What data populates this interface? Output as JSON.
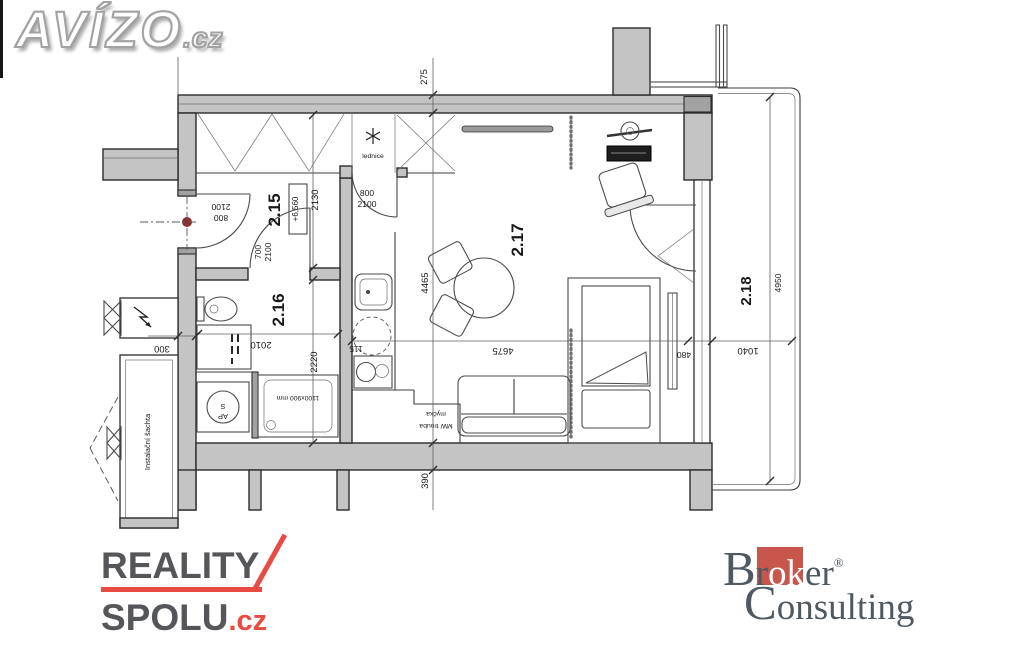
{
  "logos": {
    "avizo": {
      "name": "AVÍZO",
      "tld": ".cz"
    },
    "reality": {
      "line1": "REALITY",
      "line2": "SPOLU",
      "tld": ".cz",
      "accent_color": "#e84b42",
      "text_color": "#55565a"
    },
    "broker": {
      "pre": "Br",
      "mid": "ok",
      "post": "er",
      "reg": "®",
      "line2": "Consulting",
      "square_color": "#c7574d",
      "text_color": "#4e5961"
    }
  },
  "plan": {
    "rooms": {
      "r215": "2.15",
      "r215_elev": "+6,560",
      "r216": "2.16",
      "r217": "2.17",
      "r218": "2.18"
    },
    "dims": {
      "d275": "275",
      "d2130": "2130",
      "d115": "115",
      "d4465": "4465",
      "d4675": "4675",
      "d480": "480",
      "d390": "390",
      "d300": "300",
      "d2010": "2010",
      "d2220": "2220",
      "d4950": "4950",
      "d1040": "1040"
    },
    "doors": {
      "entry_w": "800",
      "entry_h": "2100",
      "bath_w": "700",
      "bath_h": "2100",
      "kitchen_w": "800",
      "kitchen_h": "2100"
    },
    "fixtures": {
      "fridge": "lednice",
      "shaft": "Instalační šachta",
      "shower": "1100x900 mm",
      "wm_line1": "AP",
      "wm_line2": "S",
      "mw": "MW trouba",
      "dw": "myčka"
    },
    "colors": {
      "wall": "#c4c4c4",
      "entry_dot": "#8e2f2f"
    }
  }
}
